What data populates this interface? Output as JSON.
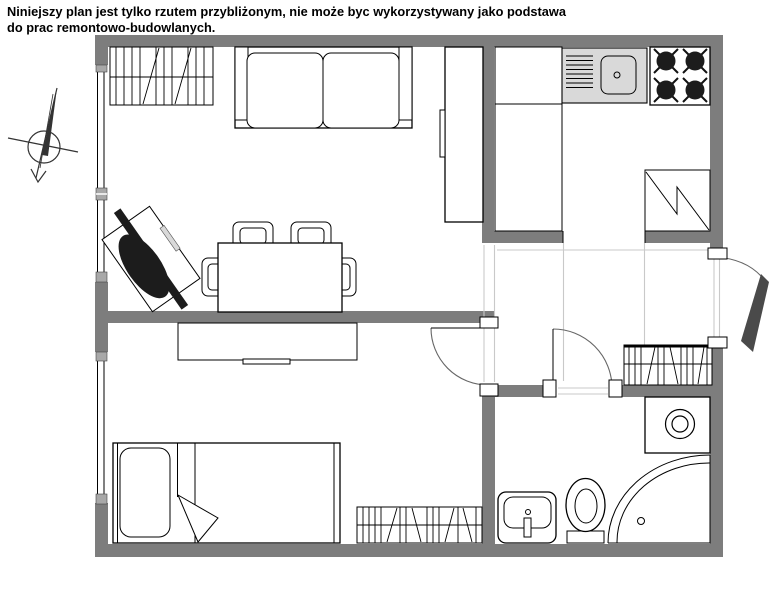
{
  "disclaimer": {
    "line1": "Niniejszy plan jest tylko rzutem przybliżonym, nie może byc wykorzystywany jako podstawa",
    "line2": "do prac remontowo-budowlanych."
  },
  "colors": {
    "background": "#ffffff",
    "wall": "#7d7d7d",
    "counter": "#d9d9d9",
    "guide": "#c9c9c9",
    "door_arc": "#666666",
    "dark_fill": "#1c1c1c",
    "window_block": "#a8a8a8",
    "outline": "#000000"
  },
  "fixtures": [
    "north-arrow",
    "window",
    "wardrobe",
    "sofa",
    "armchair",
    "dining-table",
    "chair",
    "tall-cabinet",
    "kitchen-counter",
    "kitchen-sink",
    "stove",
    "fridge",
    "desk",
    "bed",
    "washing-machine",
    "washbasin",
    "toilet",
    "corner-shower",
    "entrance-door",
    "bedroom-door",
    "bathroom-door"
  ]
}
